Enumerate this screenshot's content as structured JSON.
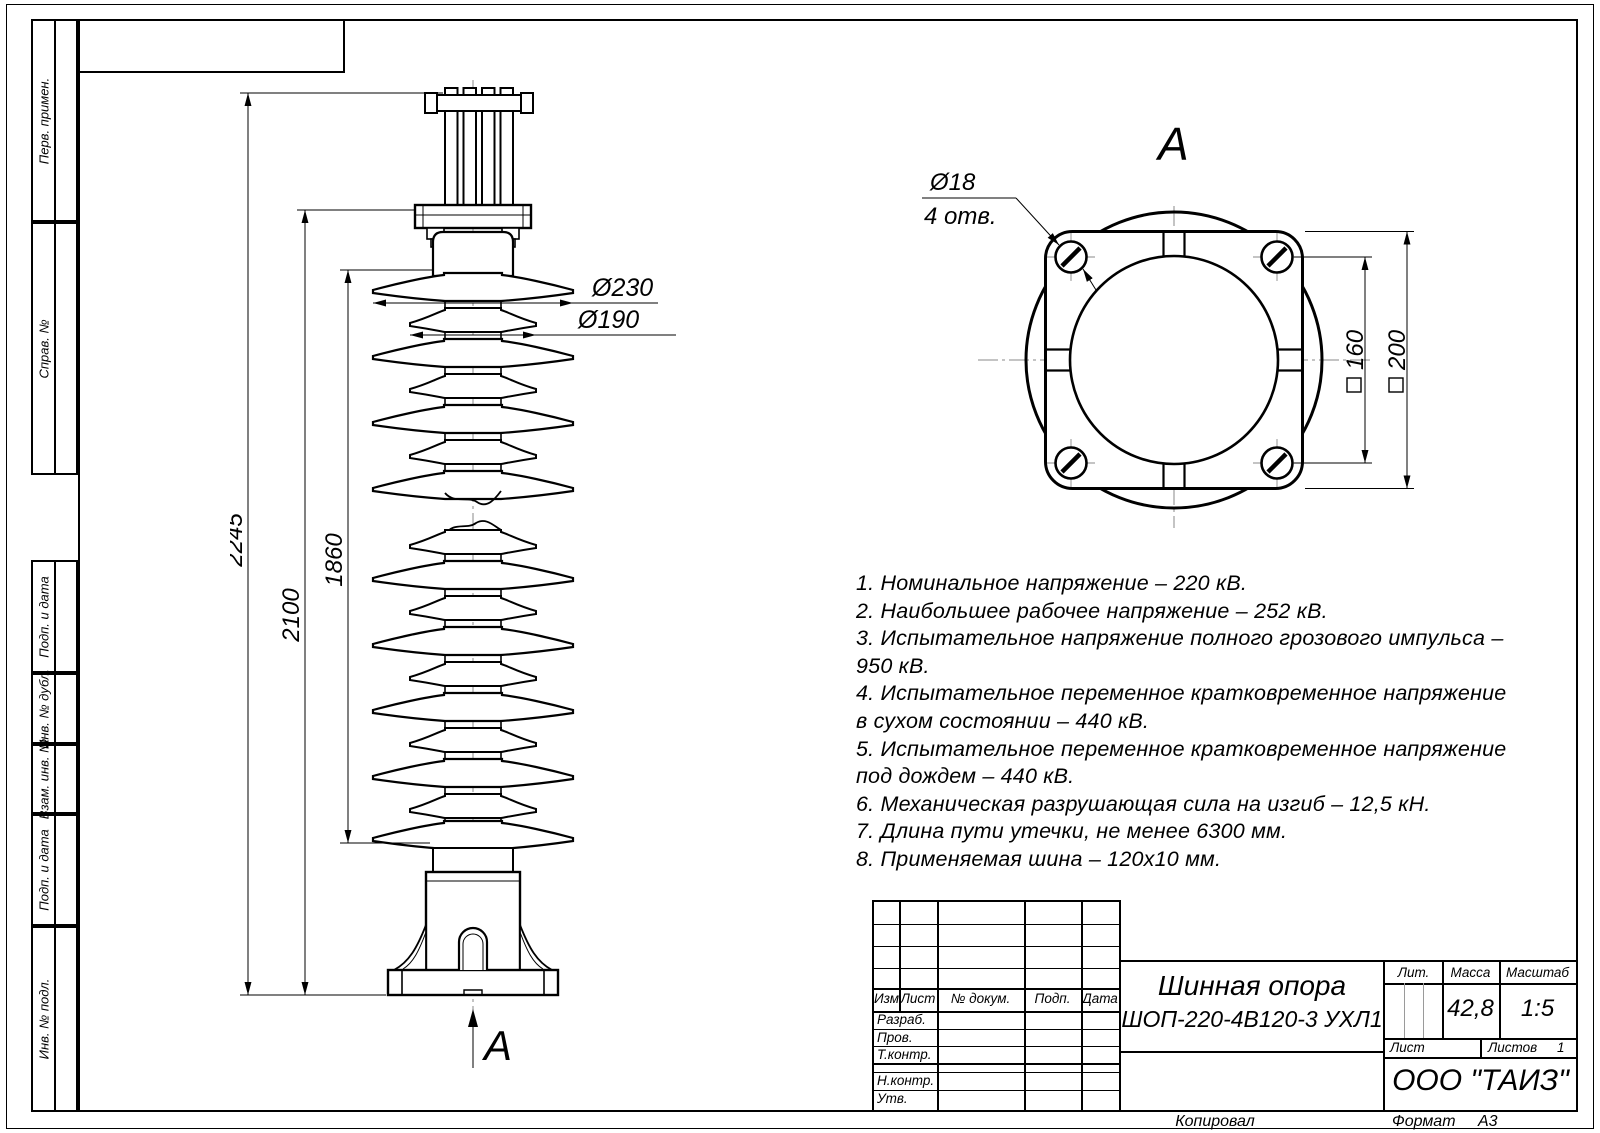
{
  "sheet": {
    "format_label": "Формат",
    "format_value": "А3",
    "copied_label": "Копировал"
  },
  "sidebar": {
    "top": [
      "Перв. примен.",
      "Справ. №"
    ],
    "bottom": [
      "Подп. и дата",
      "Инв. № дубл.",
      "Взам. инв. №",
      "Подп. и дата",
      "Инв. № подл."
    ]
  },
  "front_view": {
    "dim_total": "2245",
    "dim_to_flange": "2100",
    "dim_insulator": "1860",
    "dia_large": "Ø230",
    "dia_small": "Ø190",
    "view_arrow_label": "A"
  },
  "top_view": {
    "label": "A",
    "holes_dia": "Ø18",
    "holes_count": "4 отв.",
    "bolt_spacing": "160",
    "flange_size": "200"
  },
  "notes": {
    "lines": [
      "1. Номинальное напряжение – 220 кВ.",
      "2. Наибольшее рабочее напряжение – 252 кВ.",
      "3. Испытательное напряжение полного грозового импульса –",
      "950 кВ.",
      "4. Испытательное переменное кратковременное напряжение",
      "в сухом состоянии – 440 кВ.",
      "5. Испытательное переменное кратковременное напряжение",
      "под дождем – 440 кВ.",
      "6. Механическая разрушающая сила на изгиб – 12,5 кН.",
      "7. Длина пути утечки, не менее 6300 мм.",
      "8. Применяемая шина – 120x10 мм."
    ]
  },
  "title_block": {
    "rev_header": [
      "Изм.",
      "Лист",
      "№ докум.",
      "Подп.",
      "Дата"
    ],
    "sign_rows": [
      "Разраб.",
      "Пров.",
      "Т.контр.",
      "Н.контр.",
      "Утв."
    ],
    "name_line1": "Шинная опора",
    "name_line2": "ШОП-220-4В120-3 УХЛ1",
    "lit_label": "Лит.",
    "mass_label": "Масса",
    "mass_value": "42,8",
    "scale_label": "Масштаб",
    "scale_value": "1:5",
    "sheet_label": "Лист",
    "sheets_label": "Листов",
    "sheets_value": "1",
    "company": "ООО \"ТАИЗ\""
  }
}
